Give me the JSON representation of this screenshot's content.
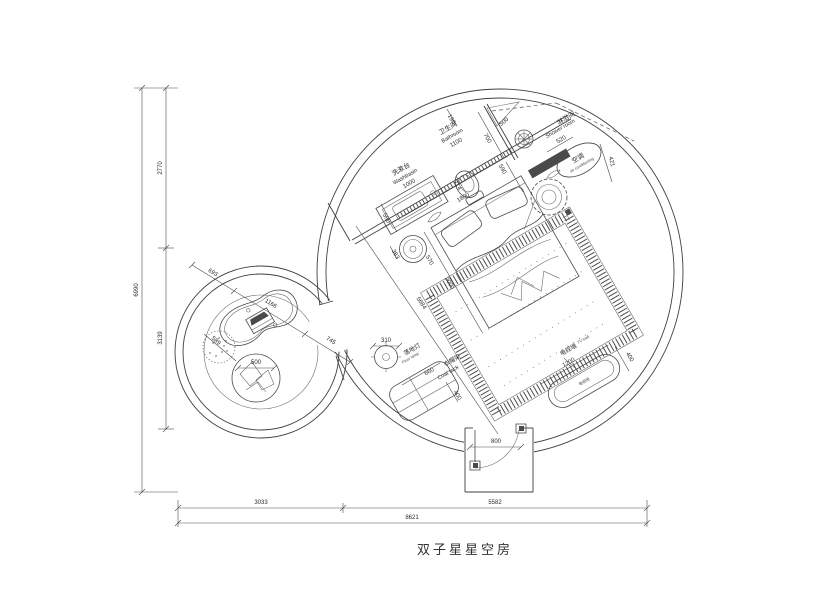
{
  "title": "双子星星空房",
  "colors": {
    "line": "#4a4a4a",
    "dark_fill": "#4a4a4a",
    "background": "#ffffff"
  },
  "labels": {
    "washbasin_zh": "洗漱台",
    "washbasin_en": "Washbasin",
    "washbasin_dim": "1000",
    "bathroom_zh": "卫生间",
    "bathroom_en": "Bathroom",
    "bathroom_dim": "1100",
    "shower_zh": "淋浴间",
    "shower_en": "Shower room",
    "ac_zh": "空调",
    "ac_en": "air conditioning",
    "tv_wall_zh": "电视墙",
    "tv_wall_en": "TV wall",
    "tv_cabinet": "电视柜",
    "floor_lamp_zh": "落地灯",
    "floor_lamp_en": "Floor lamp",
    "coat_rack_zh": "衣帽架",
    "coat_rack_en": "Coat rack"
  },
  "dimensions": {
    "d190": "190",
    "d700": "700",
    "d500_top": "500",
    "d590": "590",
    "d520": "520",
    "d421": "421",
    "d714": "714",
    "d1800": "1800",
    "d550": "550",
    "d383": "383",
    "d570": "570",
    "d2000": "2000",
    "d5684": "5684",
    "d310": "310",
    "d660": "660",
    "d400_rack": "400",
    "d1200": "1200",
    "d400_tv": "400",
    "d800": "800",
    "d693": "693",
    "d1166": "1166",
    "d745": "745",
    "d589": "589",
    "d500_left": "500"
  },
  "overall": {
    "height_total": "6990",
    "height_upper": "2770",
    "height_lower": "3139",
    "width_left": "3033",
    "width_right": "5582",
    "width_total": "8621"
  }
}
